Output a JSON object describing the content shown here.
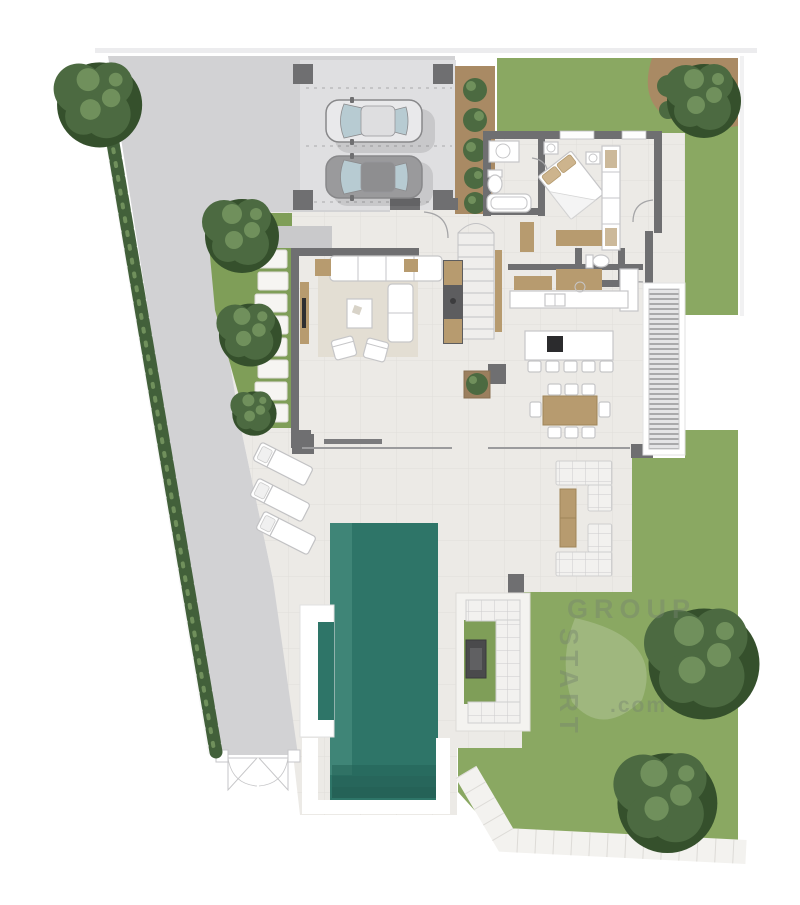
{
  "watermark": {
    "vertical": "START",
    "horizontal": "GROUP",
    "suffix": ".com"
  },
  "palette": {
    "concrete": "#d2d2d4",
    "carport": "#dfdfe1",
    "tile": "#eceae6",
    "tile-line": "#dbd9d5",
    "lawn": "#8aa862",
    "garden": "#7f9e58",
    "bed-soil": "#a98a64",
    "pool": "#2e7568",
    "pool-light": "#3f8577",
    "pool-step": "#256257",
    "wall": "#6f6f71",
    "wood": "#b79b6f",
    "hedge": "#42603a",
    "tree": "#4c6a41",
    "tree-dark": "#35502c",
    "tree-light": "#70905c",
    "furniture-line": "#c6c6c8",
    "car-silver": "#e9e9eb",
    "car-gray": "#9a9a9c",
    "car-glass": "#b7cbd2",
    "watermark": "#76836f"
  },
  "counts": {
    "cars": 2,
    "sun_loungers": 3,
    "bar_stools": 5,
    "dining_chairs": 8,
    "carport_columns": 4
  }
}
